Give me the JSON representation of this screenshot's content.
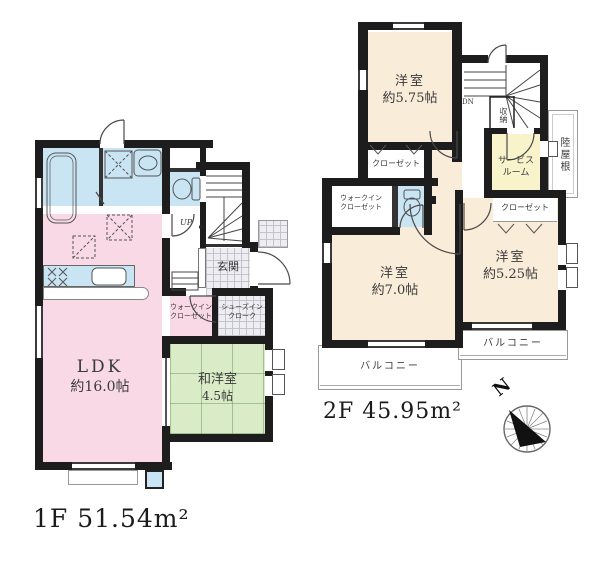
{
  "canvas": {
    "bg": "#ffffff",
    "wall_color": "#1d1d1d"
  },
  "palette": {
    "pink": "#f8d9e5",
    "blue": "#c9e4f3",
    "green": "#d9ecc7",
    "cream": "#f9ecd9",
    "yellow": "#f8f3cb"
  },
  "floor1": {
    "area_label": "1F 51.54m²",
    "ldk": {
      "line1": "LDK",
      "line2": "約16.0帖"
    },
    "washitsu": {
      "line1": "和洋室",
      "line2": "4.5帖"
    },
    "genkan": "玄関",
    "walk_in_closet": {
      "line1": "ウォークイン",
      "line2": "クローゼット"
    },
    "shoes_in_cloak": {
      "line1": "シューズイン",
      "line2": "クローク"
    },
    "stairs_label": "UP"
  },
  "floor2": {
    "area_label": "2F 45.95m²",
    "bedroom_575": {
      "line1": "洋室",
      "line2": "約5.75帖"
    },
    "bedroom_70": {
      "line1": "洋室",
      "line2": "約7.0帖"
    },
    "bedroom_525": {
      "line1": "洋室",
      "line2": "約5.25帖"
    },
    "service_room": {
      "line1": "サービス",
      "line2": "ルーム"
    },
    "closet_575": "クローゼット",
    "closet_525": "クローゼット",
    "walk_in_closet": {
      "line1": "ウォークイン",
      "line2": "クローゼット"
    },
    "storage": "収納",
    "flat_roof": "陸屋根",
    "balcony_70": "バルコニー",
    "balcony_525": "バルコニー",
    "stairs_label": "DN"
  },
  "compass": {
    "north": "N"
  }
}
